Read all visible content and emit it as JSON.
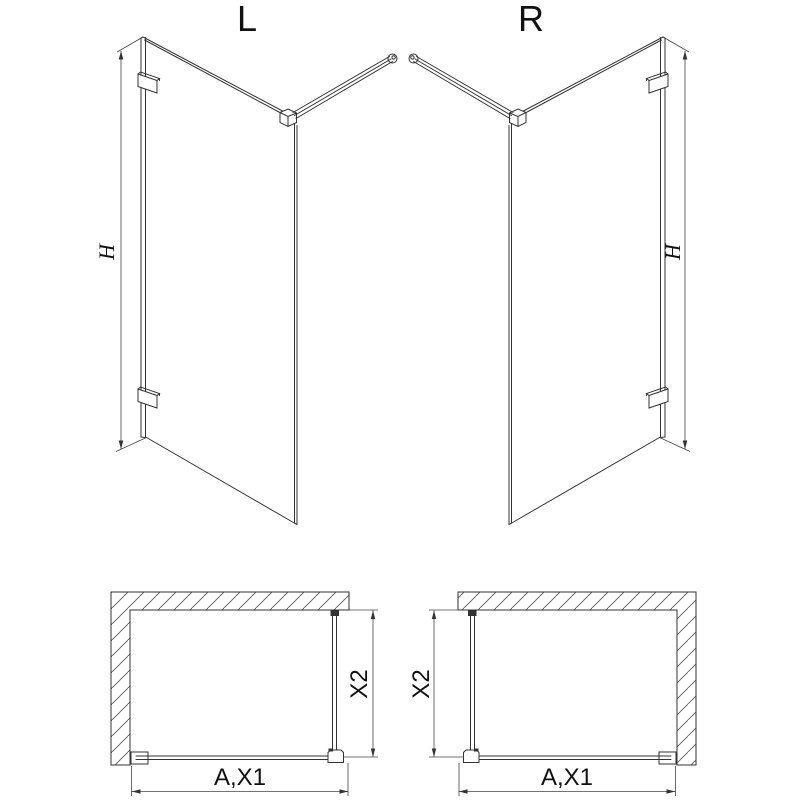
{
  "drawing": {
    "type": "technical-diagram-walk-in-shower-screen",
    "views": {
      "iso_left": {
        "label": "L",
        "height_dim": "H"
      },
      "iso_right": {
        "label": "R",
        "height_dim": "H"
      },
      "plan_left": {
        "width_dim": "A,X1",
        "depth_dim": "X2"
      },
      "plan_right": {
        "width_dim": "A,X1",
        "depth_dim": "X2"
      }
    },
    "colors": {
      "line": "#333333",
      "background": "#ffffff",
      "text": "#111111"
    }
  }
}
